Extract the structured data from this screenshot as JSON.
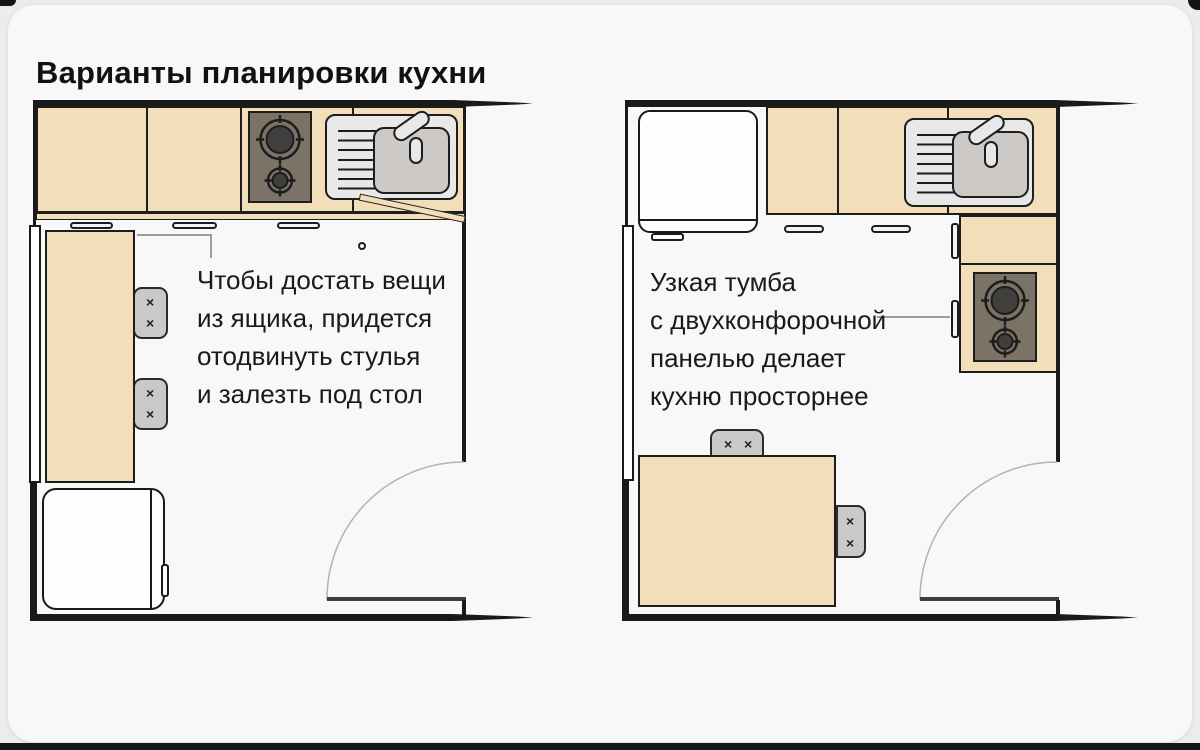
{
  "title": "Варианты планировки кухни",
  "plans": [
    {
      "name": "kitchen-plan-table-along-wall",
      "annotation": {
        "lines": [
          "Чтобы достать вещи",
          "из ящика, придется",
          "отодвинуть стулья",
          "и залезть под стол"
        ]
      }
    },
    {
      "name": "kitchen-plan-narrow-cabinet",
      "annotation": {
        "lines": [
          "Узкая тумба",
          "с двухконфорочной",
          "панелью делает",
          "кухню просторнее"
        ]
      }
    }
  ],
  "colors": {
    "page_bg": "#ebedec",
    "card_bg": "#f8f8f8",
    "wall": "#1a1a1a",
    "counter_beige": "#f2deb8",
    "stove_panel": "#7b7365",
    "burner": "#403f3d",
    "sink_gray": "#e8e8e9",
    "basin_gray": "#cdc9c6",
    "chair_gray": "#c9c9c9",
    "leader_line": "#9e9e9e",
    "accent_dark_bar": "#141414"
  }
}
